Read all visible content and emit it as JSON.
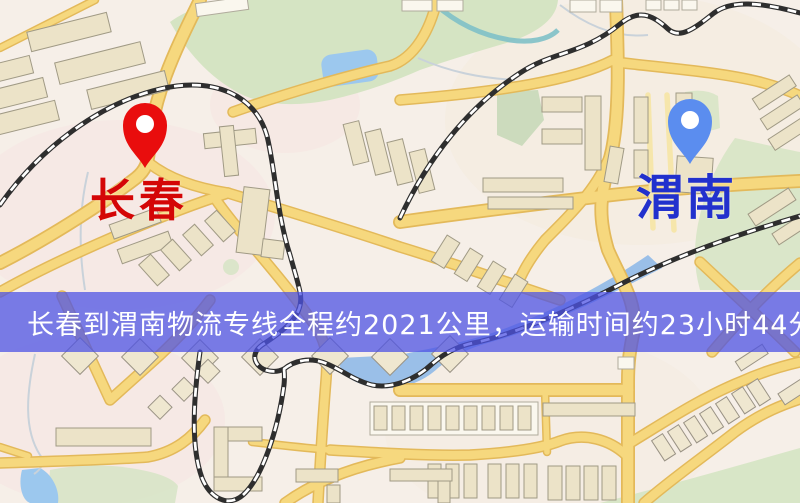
{
  "banner": {
    "text": "长春到渭南物流专线全程约2021公里，运输时间约23小时44分钟."
  },
  "route": {
    "origin": "长春",
    "destination": "渭南",
    "distance_km": "2021",
    "duration": "23小时44分钟"
  },
  "origin": {
    "name": "长春"
  },
  "destination": {
    "name": "渭南"
  },
  "theme": {
    "map_bg": "#f6efe8",
    "banner_bg": "#4e53e4bf",
    "banner_text": "#ffffff",
    "origin_pin": "#e90d0d",
    "origin_label": "#d40606",
    "destination_pin": "#5b8def",
    "destination_label": "#2231cd",
    "road_fill": "#f6d87e",
    "road_casing": "#e3b95a",
    "railway": "#2e2e2e",
    "water": "#9cc8ee",
    "green": "#d5e4c3",
    "building": "#ece3c8"
  }
}
